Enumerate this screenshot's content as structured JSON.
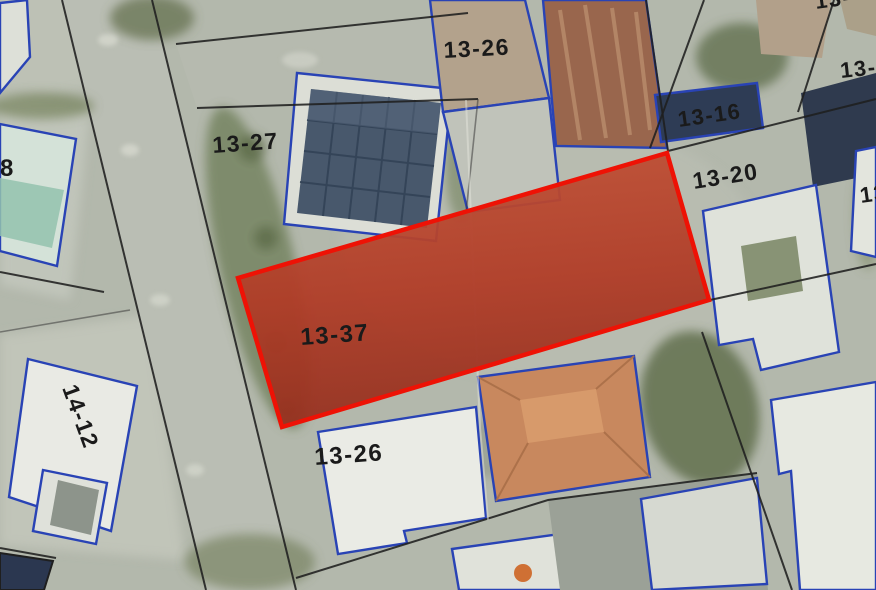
{
  "map": {
    "title": "Aerial cadastral map with highlighted parcel",
    "highlight": {
      "parcel_id": "13-37",
      "fill": "#bf4c33",
      "border": "#ee1205",
      "label_color": "#7d2114"
    },
    "colors": {
      "parcel_outline_blue": "#2943b5",
      "boundary_line_black": "#1f1f1f",
      "road_gray": "#babeb4",
      "vegetation_green": "#6e7c55",
      "label_text": "#1a1a1a"
    },
    "labels": [
      {
        "name": "parcel-13-26-north",
        "text": "13-26"
      },
      {
        "name": "parcel-13-27",
        "text": "13-27"
      },
      {
        "name": "parcel-13-16",
        "text": "13-16"
      },
      {
        "name": "parcel-13-20",
        "text": "13-20"
      },
      {
        "name": "parcel-13-partial-upper-right",
        "text": "13-"
      },
      {
        "name": "parcel-13-partial-top-edge",
        "text": "13-"
      },
      {
        "name": "parcel-8-partial-left",
        "text": "8"
      },
      {
        "name": "parcel-13-37-highlighted",
        "text": "13-37"
      },
      {
        "name": "parcel-13-26-south",
        "text": "13-26"
      },
      {
        "name": "parcel-14-12",
        "text": "14-12"
      },
      {
        "name": "parcel-13-partial-right",
        "text": "13"
      }
    ]
  }
}
